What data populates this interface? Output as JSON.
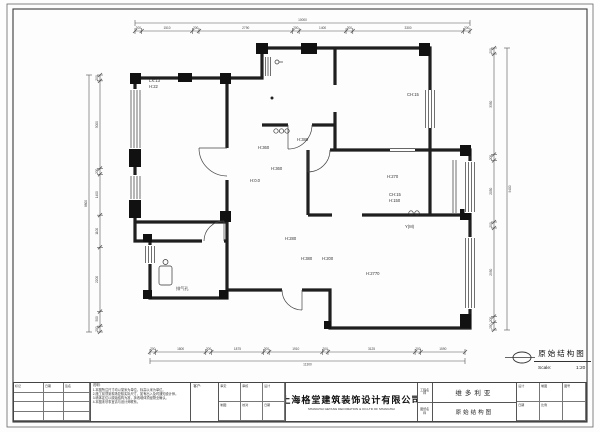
{
  "doc": {
    "sheet_bg": "#fdfdfd",
    "line_color": "#222222",
    "dim_color": "#555555"
  },
  "title_bubble": {
    "title": "原始结构图",
    "scale_label": "Scale:",
    "scale_value": "1:20"
  },
  "dims": {
    "top": {
      "total": "10000",
      "segs": [
        "200",
        "1510",
        "200",
        "2790",
        "200",
        "1400",
        "200",
        "3300",
        "200"
      ]
    },
    "bottom": {
      "total": "11300",
      "segs": [
        "200",
        "1800",
        "200",
        "1875",
        "200",
        "1910",
        "200",
        "3125",
        "200",
        "1590"
      ]
    },
    "left": {
      "total": "8800",
      "segs": [
        "200",
        "3000",
        "200",
        "1400",
        "1100",
        "2200",
        "500",
        "200"
      ]
    },
    "right": {
      "total": "9400",
      "segs": [
        "200",
        "3350",
        "200",
        "2050",
        "200",
        "2950",
        "200",
        "250"
      ]
    }
  },
  "plan": {
    "labels": [
      {
        "text": "LX:13",
        "x": 149,
        "y": 82
      },
      {
        "text": "H:22",
        "x": 149,
        "y": 88
      },
      {
        "text": "CH:15",
        "x": 407,
        "y": 96
      },
      {
        "text": "H:380",
        "x": 297,
        "y": 141
      },
      {
        "text": "H:360",
        "x": 258,
        "y": 149
      },
      {
        "text": "H:360",
        "x": 271,
        "y": 170
      },
      {
        "text": "H:0.0",
        "x": 250,
        "y": 182
      },
      {
        "text": "H:270",
        "x": 387,
        "y": 178
      },
      {
        "text": "CH:15",
        "x": 389,
        "y": 196
      },
      {
        "text": "H:150",
        "x": 389,
        "y": 202
      },
      {
        "text": "Y(M)",
        "x": 405,
        "y": 228
      },
      {
        "text": "H:280",
        "x": 285,
        "y": 240
      },
      {
        "text": "H:380",
        "x": 301,
        "y": 260
      },
      {
        "text": "H:200",
        "x": 322,
        "y": 260
      },
      {
        "text": "H:2770",
        "x": 366,
        "y": 275
      },
      {
        "text": "排气孔",
        "x": 176,
        "y": 290
      }
    ]
  },
  "titleblock": {
    "rev_headers": [
      "标记",
      "日期",
      "签名"
    ],
    "notes_title": "说明:",
    "notes_lines": [
      "1.本图所注尺寸均以毫米为单位，标高以米为单位。",
      "2.施工前须到现场复核实际尺寸，如有出入及时通知设计师。",
      "3.墙体定位以原始结构为准，拆改墙体须经物业确认。",
      "4.本图未尽事宜请与设计师联系。"
    ],
    "client_label": "客户:",
    "sig_cells": [
      "审定",
      "审核",
      "设计",
      "制图",
      "校对",
      "日期"
    ],
    "company_cn": "上海格堂建筑装饰设计有限公司",
    "company_en": "SHANGHAI GETANG DECORATION & CO.LTD OF SHANGHAI",
    "project_label": "工程名称",
    "drawing_label": "图纸名称",
    "project_name": "维多利亚",
    "drawing_name": "原始结构图",
    "right_cells": [
      "设计",
      "制图",
      "图号",
      "日期",
      "比例",
      ""
    ]
  }
}
